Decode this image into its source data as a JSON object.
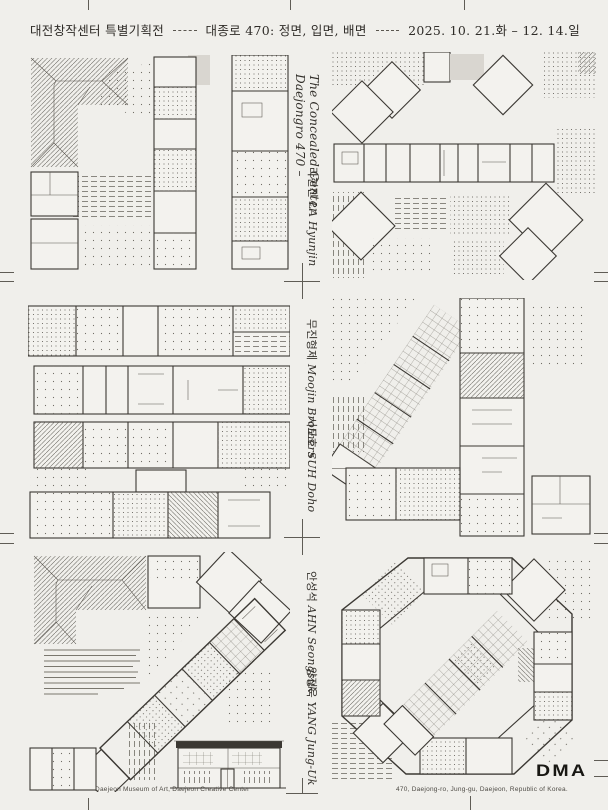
{
  "poster": {
    "header": {
      "exhibition": "대전창작센터 특별기획전",
      "title": "대종로 470: 정면, 입면, 배면",
      "dates": "2025. 10. 21.화 – 12. 14.일"
    },
    "spine": {
      "series_title_line1": "Daejongro 470 –",
      "series_title_line2": "The Concealed Center",
      "artists": [
        {
          "ko": "라현진",
          "en": "LA Hyunjin"
        },
        {
          "ko": "무진형제",
          "en": "Moojin Brothers"
        },
        {
          "ko": "서도호",
          "en": "SUH Doho"
        },
        {
          "ko": "안성석",
          "en": "AHN Seongsuk"
        },
        {
          "ko": "양정욱",
          "en": "YANG Jung-Uk"
        }
      ]
    },
    "footer": {
      "venue": "Daejeon Museum of Art, Daejeon Creative Center",
      "address": "470, Daejong-ro, Jung-gu, Daejeon, Republic of Korea.",
      "logo": "DMA"
    },
    "colors": {
      "background": "#f0efeb",
      "ink": "#3b3833",
      "gray_block": "#d9d6d0"
    }
  }
}
